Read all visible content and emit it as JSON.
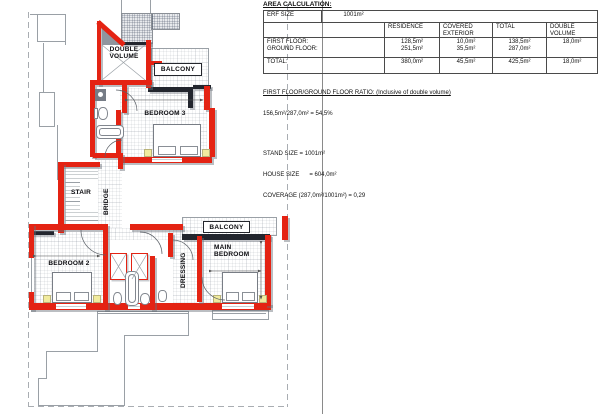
{
  "document": {
    "title": "AREA CALCULATION:"
  },
  "table": {
    "erf": {
      "label": "ERF SIZE",
      "value": "1001m²"
    },
    "columns": {
      "c1": "RESIDENCE",
      "c2": "COVERED EXTERIOR",
      "c3": "TOTAL",
      "c4": "DOUBLE VOLUME"
    },
    "first_floor": {
      "label": "FIRST FLOOR:",
      "residence": "128,5m²",
      "covered": "10,0m²",
      "total": "138,5m²",
      "double_volume": "18,0m²"
    },
    "ground_floor": {
      "label": "GROUND FLOOR:",
      "residence": "251,5m²",
      "covered": "35,5m²",
      "total": "287,0m²",
      "double_volume": ""
    },
    "total_row": {
      "label": "TOTAL:",
      "residence": "380,0m²",
      "covered": "45,5m²",
      "total": "425,5m²",
      "double_volume": "18,0m²"
    }
  },
  "notes": {
    "ratio_heading": "FIRST FLOOR/GROUND FLOOR RATIO: (Inclusive of double volume)",
    "ratio_value": "156,5m²/287,0m² = 54,5%",
    "stand_size": "STAND SIZE = 1001m²",
    "house_size": "HOUSE SIZE      = 604,0m²",
    "coverage": "COVERAGE (287,0m²/1001m²) = 0,29"
  },
  "plan": {
    "labels": {
      "double_volume": "DOUBLE\nVOLUME",
      "balcony_upper": "BALCONY",
      "bedroom3": "BEDROOM 3",
      "stair": "STAIR",
      "bridge": "BRIDGE",
      "balcony_main": "BALCONY",
      "bedroom2": "BEDROOM 2",
      "dressing": "DRESSING",
      "main_bedroom": "MAIN\nBEDROOM"
    },
    "colors": {
      "wall_red": "#e42313",
      "wall_dark": "#23262e",
      "accent_yellow": "#f1eb9e"
    }
  }
}
